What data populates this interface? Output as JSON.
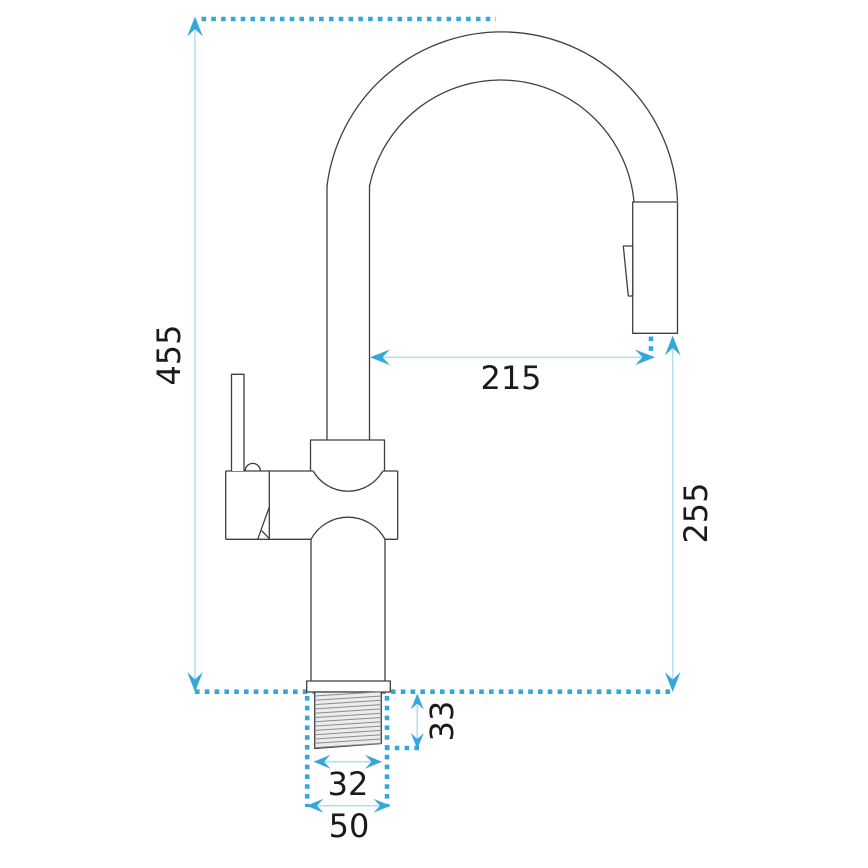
{
  "diagram": {
    "type": "technical-dimension-drawing",
    "subject": "pull-out kitchen faucet side view with dimensions",
    "dimensions": {
      "total_height": "455",
      "spout_reach": "215",
      "outlet_height": "255",
      "shank_length": "33",
      "shank_diameter": "32",
      "base_diameter": "50"
    },
    "colors": {
      "dimension_accent": "#35a7db",
      "dimension_shaft": "#b5ddef",
      "outline": "#3f3f3f",
      "text": "#1a1a1a",
      "thread_fill": "#ececec",
      "thread_hatch": "#8c8c8c",
      "background": "#ffffff"
    }
  }
}
